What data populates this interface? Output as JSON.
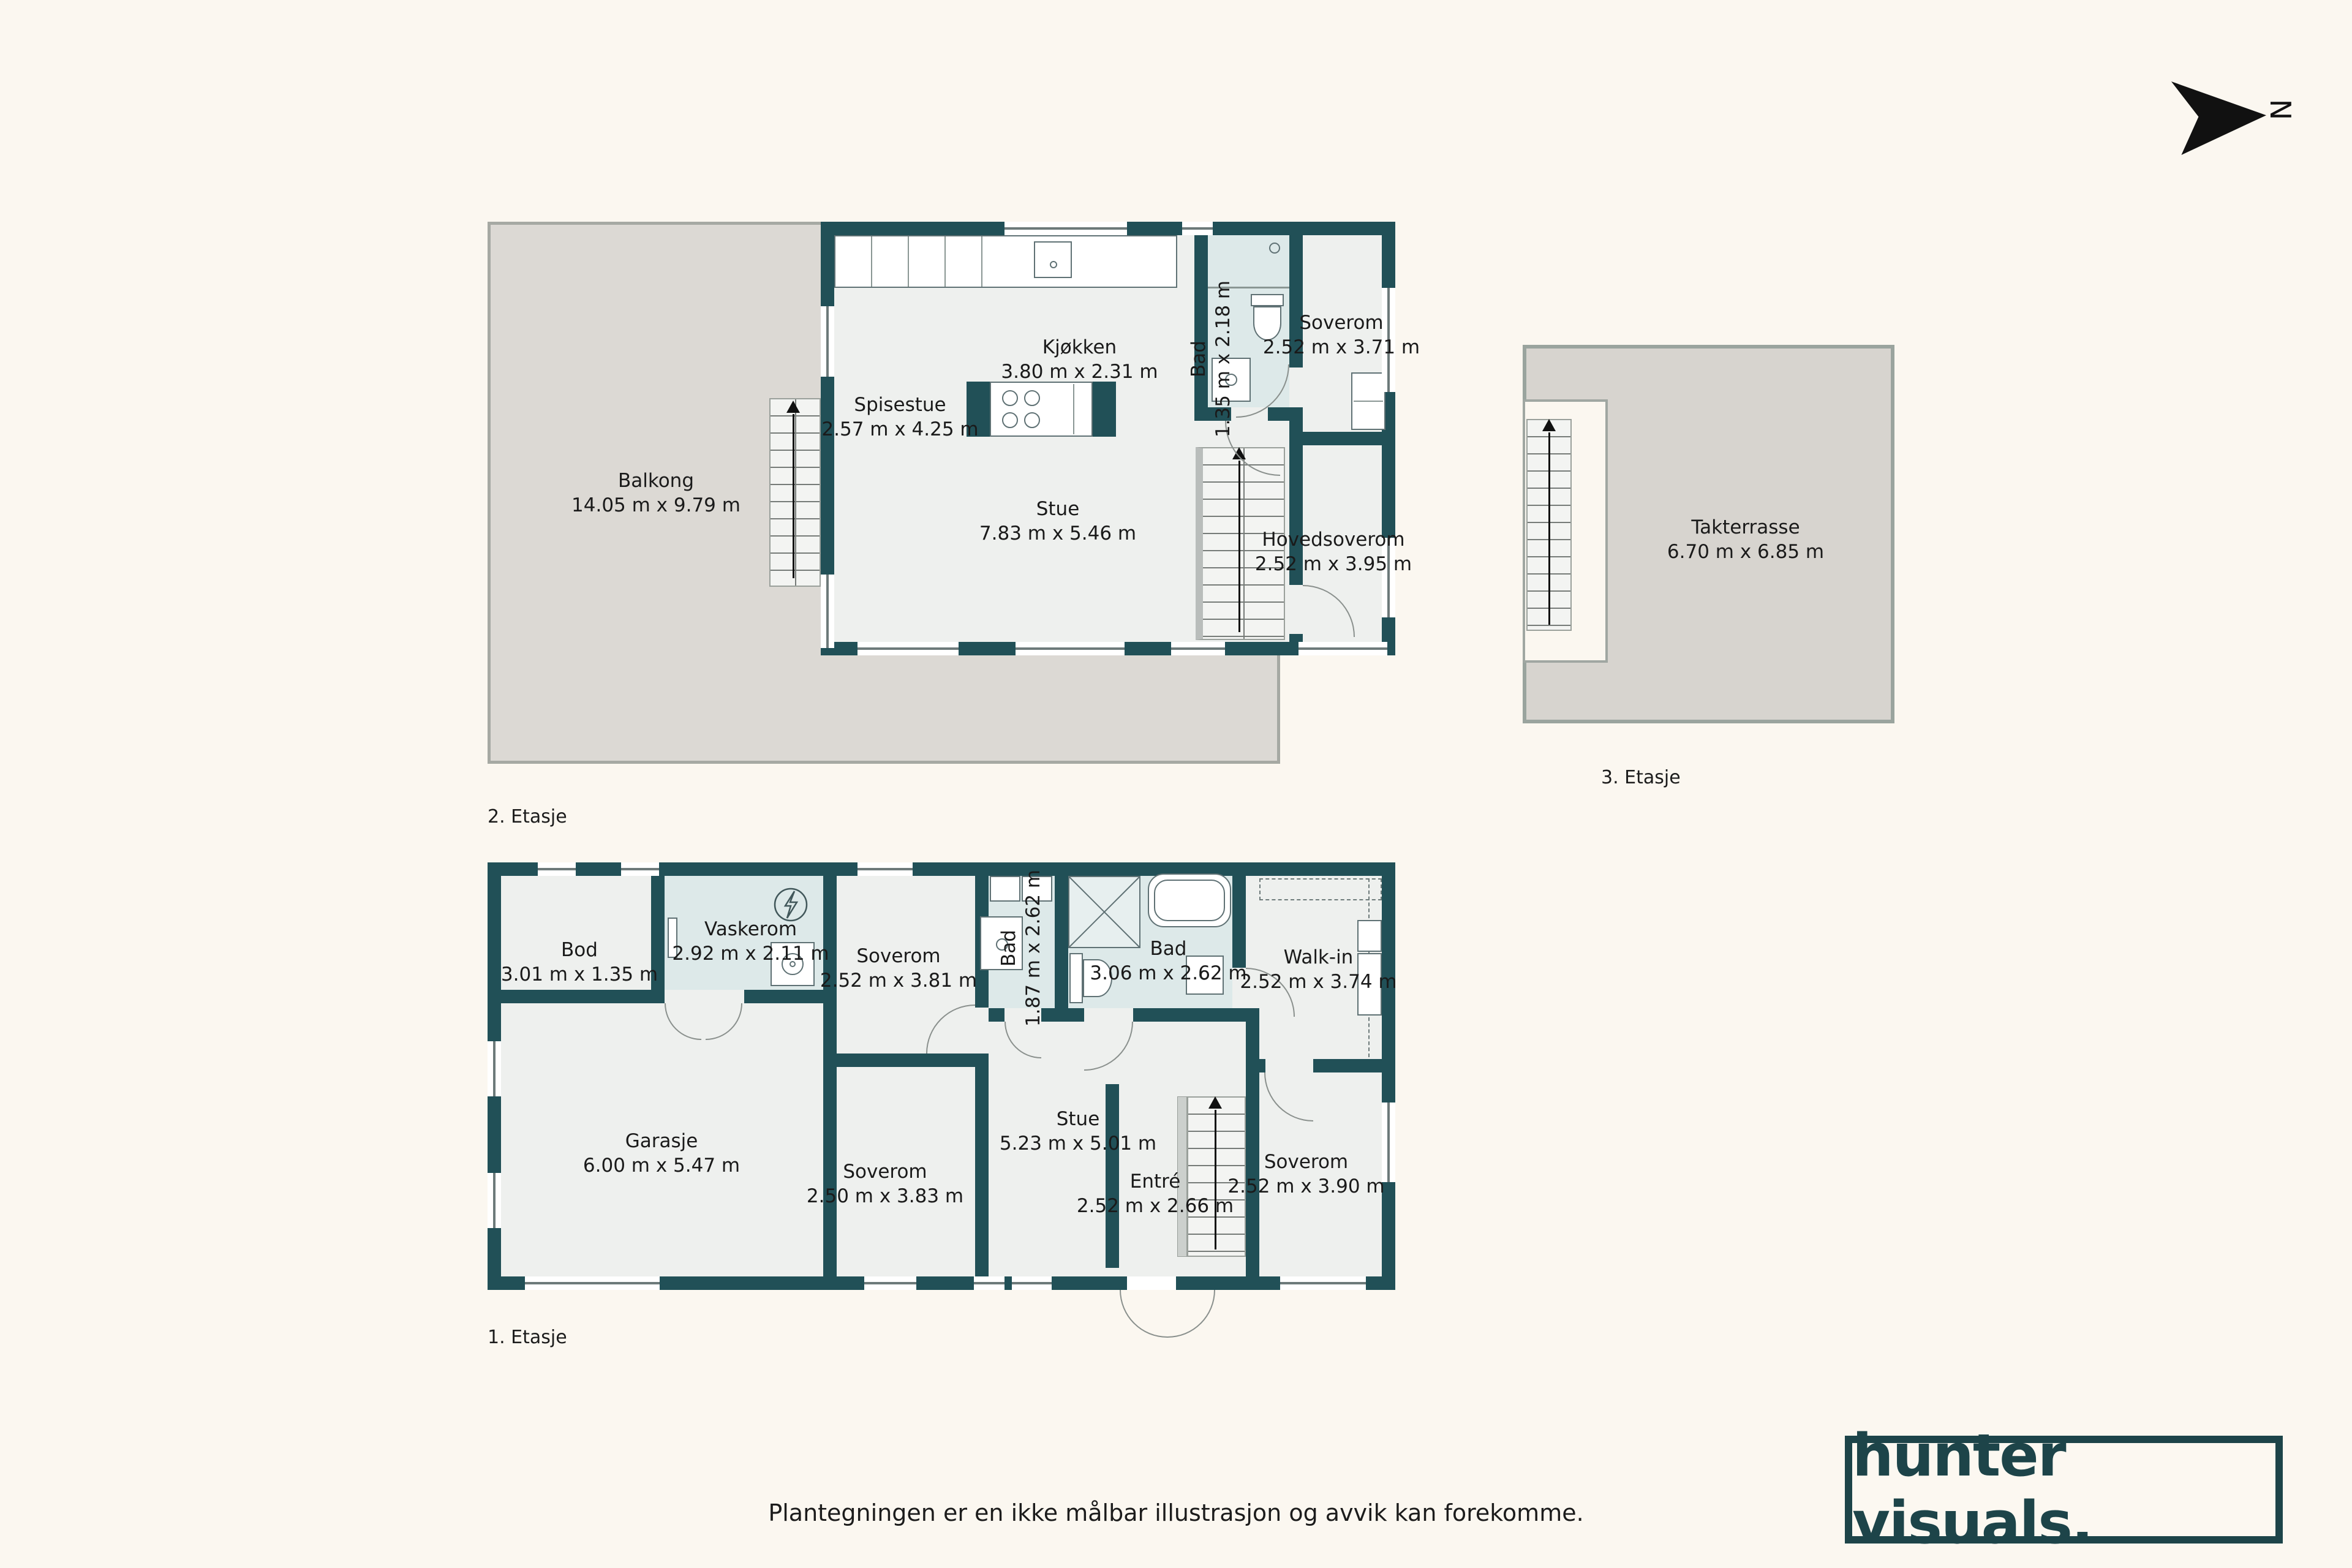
{
  "page": {
    "background": "#fbf7f0",
    "footer": "Plantegningen er en ikke målbar illustrasjon og avvik kan forekomme.",
    "north_label": "N"
  },
  "brand": {
    "name": "hunter visuals.",
    "color": "#1d4449"
  },
  "colors": {
    "wall": "#215057",
    "room_fill": "#eef0ee",
    "wet_room_fill": "#dde9e9",
    "outdoor_fill": "#dcd9d4",
    "outdoor_border": "#a6a9a3",
    "accent_dark": "#1d4449",
    "background": "#fbf7f0"
  },
  "floors": [
    {
      "id": "2-etasje",
      "label": "2. Etasje",
      "rooms": [
        {
          "name": "Spisestue",
          "dims": "2.57 m x 4.25 m"
        },
        {
          "name": "Kjøkken",
          "dims": "3.80 m x 2.31 m"
        },
        {
          "name": "Bad",
          "dims": "1.35 m x 2.18 m"
        },
        {
          "name": "Soverom",
          "dims": "2.52 m x 3.71 m"
        },
        {
          "name": "Stue",
          "dims": "7.83 m x 5.46 m"
        },
        {
          "name": "Hovedsoverom",
          "dims": "2.52 m x 3.95 m"
        },
        {
          "name": "Balkong",
          "dims": "14.05 m x 9.79 m"
        }
      ]
    },
    {
      "id": "3-etasje",
      "label": "3. Etasje",
      "rooms": [
        {
          "name": "Takterrasse",
          "dims": "6.70 m x 6.85 m"
        }
      ]
    },
    {
      "id": "1-etasje",
      "label": "1. Etasje",
      "rooms": [
        {
          "name": "Bod",
          "dims": "3.01 m x 1.35 m"
        },
        {
          "name": "Vaskerom",
          "dims": "2.92 m x 2.11 m"
        },
        {
          "name": "Soverom",
          "dims": "2.52 m x 3.81 m"
        },
        {
          "name": "Bad",
          "dims": "1.87 m x 2.62 m"
        },
        {
          "name": "Bad",
          "dims": "3.06 m x 2.62 m"
        },
        {
          "name": "Walk-in",
          "dims": "2.52 m x 3.74 m"
        },
        {
          "name": "Garasje",
          "dims": "6.00 m x 5.47 m"
        },
        {
          "name": "Soverom",
          "dims": "2.50 m x 3.83 m"
        },
        {
          "name": "Stue",
          "dims": "5.23 m x 5.01 m"
        },
        {
          "name": "Entré",
          "dims": "2.52 m x 2.66 m"
        },
        {
          "name": "Soverom",
          "dims": "2.52 m x 3.90 m"
        }
      ]
    }
  ]
}
